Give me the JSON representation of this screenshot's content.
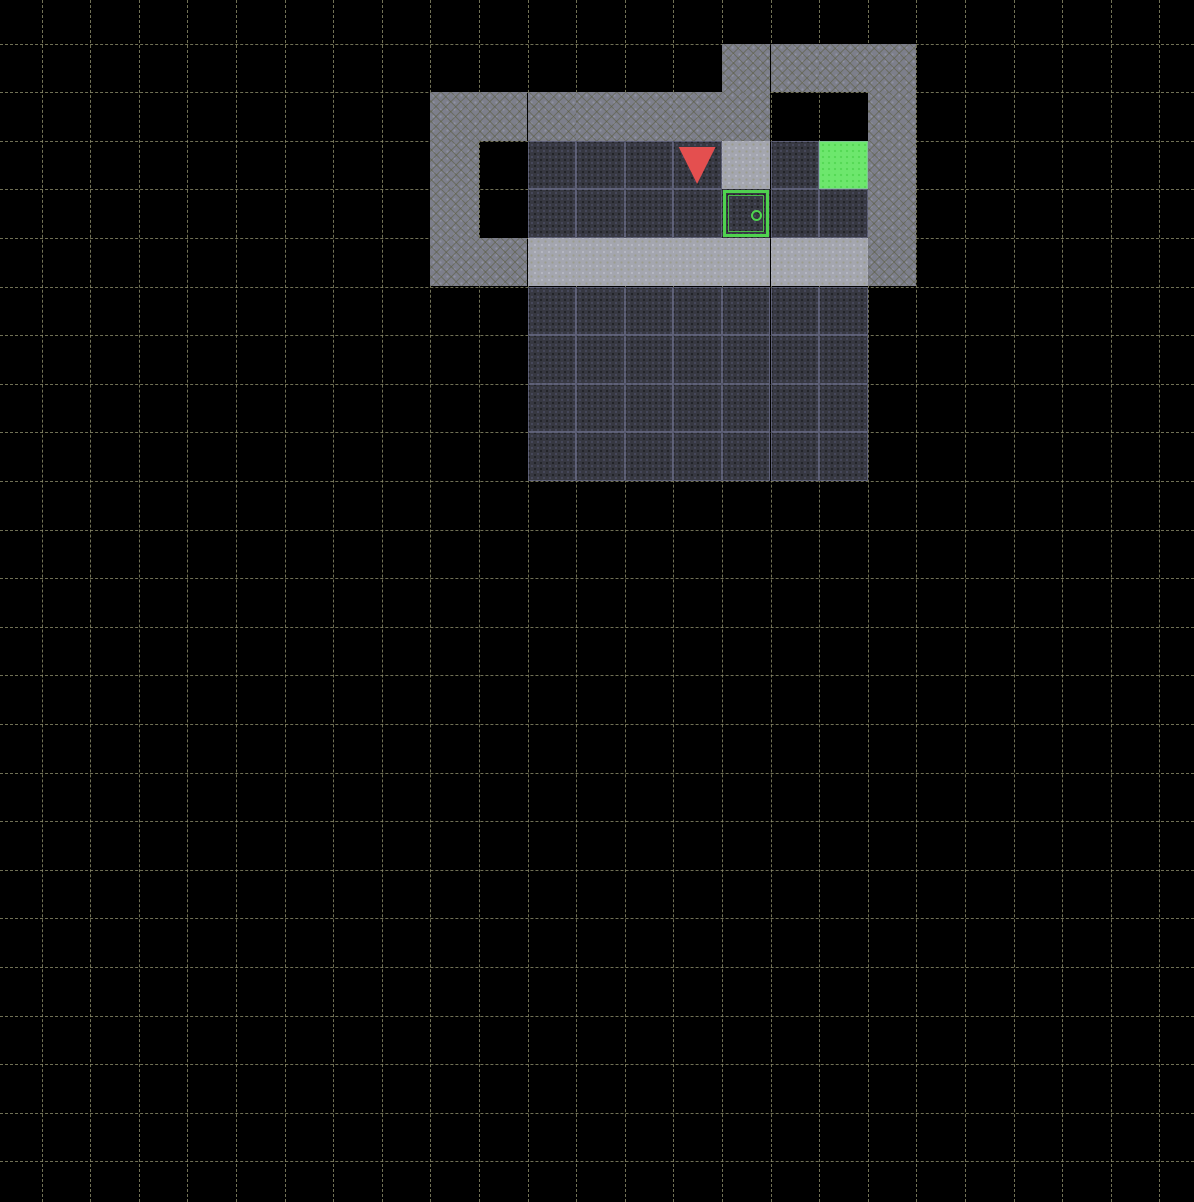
{
  "viewport": {
    "width": 1194,
    "height": 1202,
    "background_color": "#000000",
    "gridline_color": "#96966f",
    "gridline_style": "dashed"
  },
  "grid": {
    "cell_size": 48.6,
    "offset_x": 41.5,
    "offset_y": 43.5,
    "visible_cols": 24,
    "visible_rows": 24
  },
  "palette": {
    "wall": "#7d7f8b",
    "highlight": "#a4a6af",
    "floor": "#373841",
    "floor_seam": "#969bc6",
    "goal": "#6de76d",
    "door_green": "#4fd24f",
    "agent_red": "#e44f4f",
    "unexplored": "#000000"
  },
  "scene": {
    "description": "gridworld rooms: upper room with agent, goal and closed door; highlighted wall band; lower room of empty floor",
    "cells": [
      {
        "r": 0,
        "c": 14,
        "t": "wall"
      },
      {
        "r": 0,
        "c": 15,
        "t": "wall"
      },
      {
        "r": 0,
        "c": 16,
        "t": "wall"
      },
      {
        "r": 0,
        "c": 17,
        "t": "wall"
      },
      {
        "r": 1,
        "c": 8,
        "t": "wall"
      },
      {
        "r": 1,
        "c": 9,
        "t": "wall"
      },
      {
        "r": 1,
        "c": 10,
        "t": "wall"
      },
      {
        "r": 1,
        "c": 11,
        "t": "wall"
      },
      {
        "r": 1,
        "c": 12,
        "t": "wall"
      },
      {
        "r": 1,
        "c": 13,
        "t": "wall"
      },
      {
        "r": 1,
        "c": 14,
        "t": "wall"
      },
      {
        "r": 1,
        "c": 17,
        "t": "wall"
      },
      {
        "r": 2,
        "c": 8,
        "t": "wall"
      },
      {
        "r": 2,
        "c": 17,
        "t": "wall"
      },
      {
        "r": 3,
        "c": 8,
        "t": "wall"
      },
      {
        "r": 3,
        "c": 17,
        "t": "wall"
      },
      {
        "r": 4,
        "c": 8,
        "t": "wall"
      },
      {
        "r": 4,
        "c": 9,
        "t": "wall"
      },
      {
        "r": 4,
        "c": 17,
        "t": "wall"
      },
      {
        "r": 2,
        "c": 14,
        "t": "highlight"
      },
      {
        "r": 4,
        "c": 10,
        "t": "highlight"
      },
      {
        "r": 4,
        "c": 11,
        "t": "highlight"
      },
      {
        "r": 4,
        "c": 12,
        "t": "highlight"
      },
      {
        "r": 4,
        "c": 13,
        "t": "highlight"
      },
      {
        "r": 4,
        "c": 14,
        "t": "highlight"
      },
      {
        "r": 4,
        "c": 15,
        "t": "highlight"
      },
      {
        "r": 4,
        "c": 16,
        "t": "highlight"
      },
      {
        "r": 2,
        "c": 10,
        "t": "floor"
      },
      {
        "r": 2,
        "c": 11,
        "t": "floor"
      },
      {
        "r": 2,
        "c": 12,
        "t": "floor"
      },
      {
        "r": 2,
        "c": 13,
        "t": "floor"
      },
      {
        "r": 2,
        "c": 15,
        "t": "floor"
      },
      {
        "r": 3,
        "c": 10,
        "t": "floor"
      },
      {
        "r": 3,
        "c": 11,
        "t": "floor"
      },
      {
        "r": 3,
        "c": 12,
        "t": "floor"
      },
      {
        "r": 3,
        "c": 13,
        "t": "floor"
      },
      {
        "r": 3,
        "c": 15,
        "t": "floor"
      },
      {
        "r": 3,
        "c": 16,
        "t": "floor"
      },
      {
        "r": 5,
        "c": 10,
        "t": "floor"
      },
      {
        "r": 5,
        "c": 11,
        "t": "floor"
      },
      {
        "r": 5,
        "c": 12,
        "t": "floor"
      },
      {
        "r": 5,
        "c": 13,
        "t": "floor"
      },
      {
        "r": 5,
        "c": 14,
        "t": "floor"
      },
      {
        "r": 5,
        "c": 15,
        "t": "floor"
      },
      {
        "r": 5,
        "c": 16,
        "t": "floor"
      },
      {
        "r": 6,
        "c": 10,
        "t": "floor"
      },
      {
        "r": 6,
        "c": 11,
        "t": "floor"
      },
      {
        "r": 6,
        "c": 12,
        "t": "floor"
      },
      {
        "r": 6,
        "c": 13,
        "t": "floor"
      },
      {
        "r": 6,
        "c": 14,
        "t": "floor"
      },
      {
        "r": 6,
        "c": 15,
        "t": "floor"
      },
      {
        "r": 6,
        "c": 16,
        "t": "floor"
      },
      {
        "r": 7,
        "c": 10,
        "t": "floor"
      },
      {
        "r": 7,
        "c": 11,
        "t": "floor"
      },
      {
        "r": 7,
        "c": 12,
        "t": "floor"
      },
      {
        "r": 7,
        "c": 13,
        "t": "floor"
      },
      {
        "r": 7,
        "c": 14,
        "t": "floor"
      },
      {
        "r": 7,
        "c": 15,
        "t": "floor"
      },
      {
        "r": 7,
        "c": 16,
        "t": "floor"
      },
      {
        "r": 8,
        "c": 10,
        "t": "floor"
      },
      {
        "r": 8,
        "c": 11,
        "t": "floor"
      },
      {
        "r": 8,
        "c": 12,
        "t": "floor"
      },
      {
        "r": 8,
        "c": 13,
        "t": "floor"
      },
      {
        "r": 8,
        "c": 14,
        "t": "floor"
      },
      {
        "r": 8,
        "c": 15,
        "t": "floor"
      },
      {
        "r": 8,
        "c": 16,
        "t": "floor"
      },
      {
        "r": 2,
        "c": 16,
        "t": "goal"
      },
      {
        "r": 3,
        "c": 14,
        "t": "door"
      }
    ],
    "agent": {
      "r": 2,
      "c": 13,
      "direction": "down",
      "color": "#e44f4f"
    },
    "door": {
      "r": 3,
      "c": 14,
      "state": "closed",
      "color": "green",
      "handle": {
        "x_pct": 70,
        "y_pct": 52
      }
    },
    "goal": {
      "r": 2,
      "c": 16,
      "color": "green"
    }
  }
}
